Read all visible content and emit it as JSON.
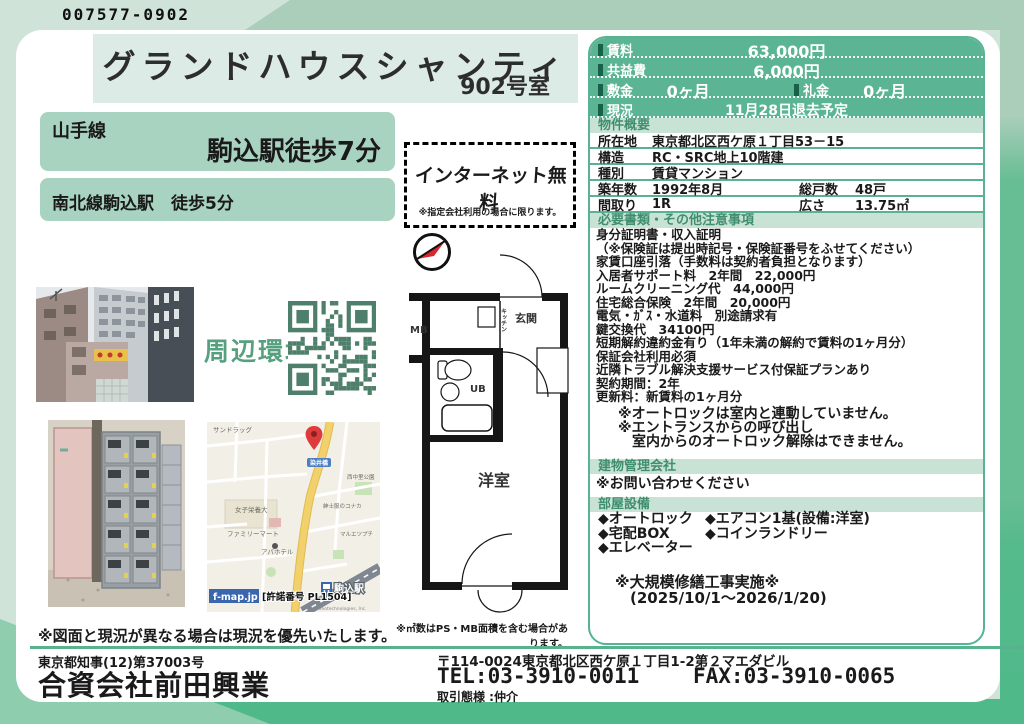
{
  "ref_code": "007577-0902",
  "header": {
    "building_name": "グランドハウスシャンティ",
    "room": "902号室"
  },
  "access": {
    "line1_name": "山手線",
    "line1_walk": "駒込駅徒歩7分",
    "line2": "南北線駒込駅　徒歩5分"
  },
  "internet_badge": {
    "title": "インターネット無料",
    "note": "※指定会社利用の場合に限ります。"
  },
  "price_table": {
    "rent_label": "賃料",
    "rent": "63,000円",
    "fee_label": "共益費",
    "fee": "6,000円",
    "deposit_label": "敷金",
    "deposit": "0ヶ月",
    "key_money_label": "礼金",
    "key_money": "0ヶ月",
    "status_label": "現況",
    "status": "11月28日退去予定"
  },
  "overview": {
    "title": "物件概要",
    "rows": [
      {
        "label": "所在地",
        "value": "東京都北区西ケ原１丁目53－15"
      },
      {
        "label": "構造",
        "value": "RC・SRC地上10階建"
      },
      {
        "label": "種別",
        "value": "賃貸マンション"
      },
      {
        "label": "築年数",
        "value": "1992年8月",
        "label2": "総戸数",
        "value2": "48戸"
      },
      {
        "label": "間取り",
        "value": "1R",
        "label2": "広さ",
        "value2": "13.75㎡"
      }
    ]
  },
  "notes_section": {
    "title": "必要書類・その他注意事項",
    "lines": [
      "身分証明書・収入証明",
      "（※保険証は提出時記号・保険証番号をふせてください）",
      "家賃口座引落（手数料は契約者負担となります）",
      "入居者サポート料　2年間　22,000円",
      "ルームクリーニング代　44,000円",
      "住宅総合保険　2年間　20,000円",
      "電気・ｶﾞｽ・水道料　別途請求有",
      "鍵交換代　34100円",
      "短期解約違約金有り（1年未満の解約で賃料の1ヶ月分）",
      "保証会社利用必須",
      "近隣トラブル解決支援サービス付保証プランあり",
      "契約期間：2年",
      "更新料：新賃料の1ヶ月分"
    ],
    "extra_notes": [
      "※オートロックは室内と連動していません。",
      "※エントランスからの呼び出し",
      "　室内からのオートロック解除はできません。"
    ]
  },
  "management": {
    "title": "建物管理会社",
    "value": "※お問い合わせください"
  },
  "equipment": {
    "title": "部屋設備",
    "col1": [
      "◆オートロック",
      "◆宅配BOX",
      "◆エレベーター"
    ],
    "col2": [
      "◆エアコン1基(設備:洋室)",
      "◆コインランドリー"
    ]
  },
  "renovation": {
    "line1": "※大規模修繕工事実施※",
    "line2": "(2025/10/1～2026/1/20)"
  },
  "surroundings_label": "周辺環境",
  "floorplan": {
    "labels": {
      "mb": "MB",
      "kitchen": "キッチン",
      "entrance": "玄関",
      "bath": "UB",
      "room": "洋室"
    },
    "note": "※㎡数はPS・MB面積を含む場合があります。"
  },
  "map": {
    "provider": "f-map.jp",
    "license": "[許諾番号 PL1504]",
    "copyright": "© Geotechnologies, Inc.",
    "labels": [
      "サンドラッグ",
      "女子栄養大",
      "ファミリーマート",
      "アパホテル",
      "紳士服のコナカ",
      "マルエツプチ",
      "西中里公園",
      "染井橋",
      "駒込駅"
    ]
  },
  "figure_note": "※図面と現況が異なる場合は現況を優先いたします。",
  "footer": {
    "license": "東京都知事(12)第37003号",
    "company": "合資会社前田興業",
    "address": "〒114-0024東京都北区西ケ原１丁目1-2第２マエダビル",
    "tel": "TEL:03-3910-0011",
    "fax": "FAX:03-3910-0065",
    "deal_type": "取引態様 :仲介"
  }
}
